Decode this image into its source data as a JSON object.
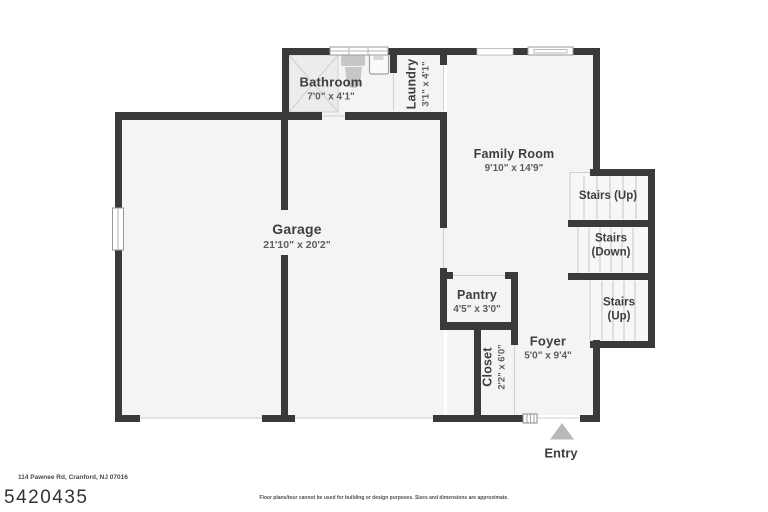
{
  "colors": {
    "wall": "#3a3a3a",
    "floor": "#f4f4f4",
    "stairs_floor": "#f7f7f7",
    "entry_arrow": "#b9b9b9"
  },
  "rooms": {
    "bathroom": {
      "name": "Bathroom",
      "dims": "7'0\" x 4'1\""
    },
    "laundry": {
      "name": "Laundry",
      "dims": "3'1\" x 4'1\""
    },
    "family_room": {
      "name": "Family Room",
      "dims": "9'10\" x 14'9\""
    },
    "garage": {
      "name": "Garage",
      "dims": "21'10\" x 20'2\""
    },
    "pantry": {
      "name": "Pantry",
      "dims": "4'5\" x 3'0\""
    },
    "closet": {
      "name": "Closet",
      "dims": "2'2\" x 6'0\""
    },
    "foyer": {
      "name": "Foyer",
      "dims": "5'0\" x 9'4\""
    }
  },
  "stairs": {
    "upper_label": "Stairs (Up)",
    "down_line1": "Stairs",
    "down_line2": "(Down)",
    "lower_line1": "Stairs",
    "lower_line2": "(Up)"
  },
  "entry_label": "Entry",
  "footer": {
    "address": "114 Pawnee Rd, Cranford, NJ 07016",
    "mls_number": "5420435",
    "disclaimer": "Floor plans/tour cannot be used for building or design purposes. Sizes and dimensions are approximate."
  }
}
